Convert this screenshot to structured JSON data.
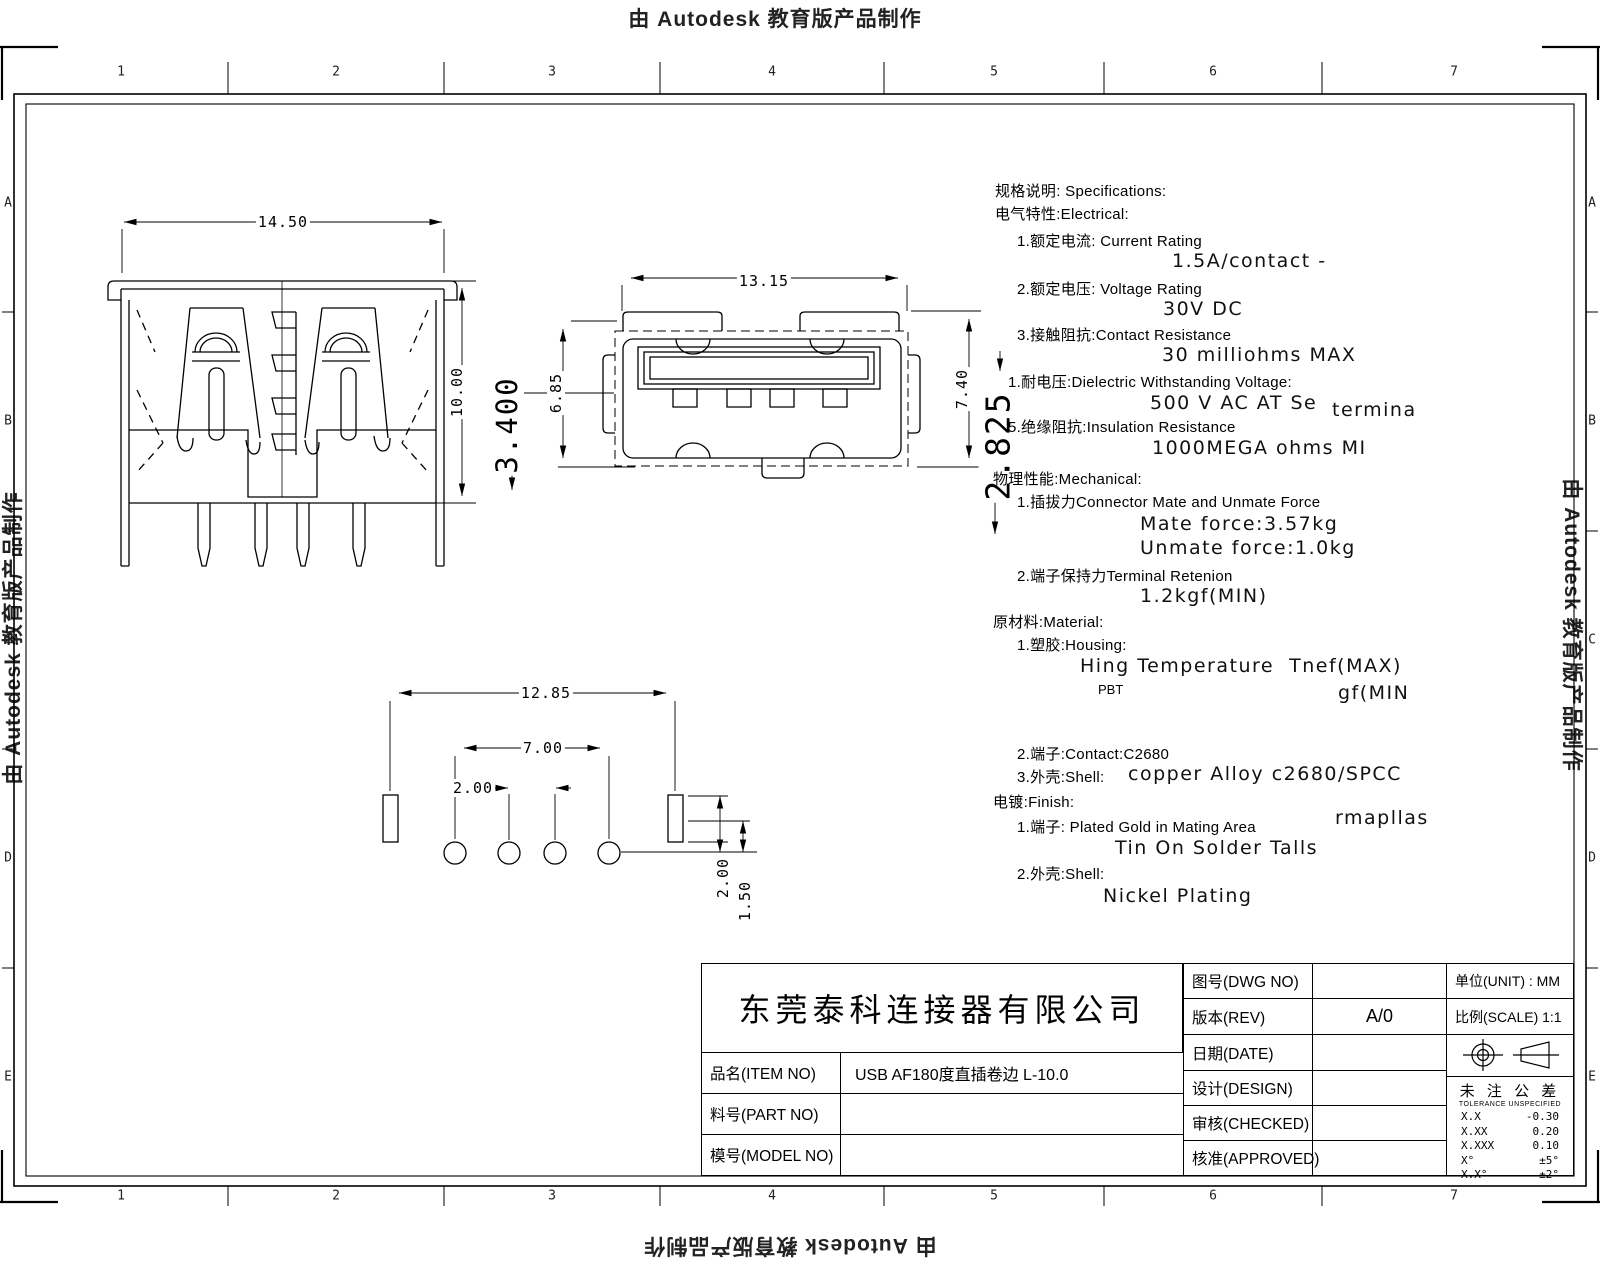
{
  "banner": {
    "text": "由 Autodesk 教育版产品制作"
  },
  "zones": {
    "cols": [
      "1",
      "2",
      "3",
      "4",
      "5",
      "6",
      "7"
    ],
    "rows": [
      "A",
      "B",
      "C",
      "D",
      "E"
    ]
  },
  "dims": {
    "front_width": "14.50",
    "front_height": "10.00",
    "front_aux": "3.400",
    "face_width": "13.15",
    "face_height_left": "6.85",
    "face_height_right": "7.40",
    "face_aux": "2.825",
    "pin_overall": "12.85",
    "pin_span": "7.00",
    "pin_pitch": "2.00",
    "pin_slot": "2.00",
    "pin_offset": "1.50"
  },
  "specs": {
    "lines": [
      {
        "t": "规格说明: Specifications:"
      },
      {
        "t": "电气特性:Electrical:"
      },
      {
        "t": "1.额定电流: Current Rating"
      },
      {
        "t": "1.5A/contact -"
      },
      {
        "t": "2.额定电压: Voltage Rating"
      },
      {
        "t": "30V DC"
      },
      {
        "t": "3.接触阻抗:Contact Resistance"
      },
      {
        "t": "30 milliohms MAX"
      },
      {
        "t": "1.耐电压:Dielectric Withstanding Voltage:"
      },
      {
        "t": "500 V AC AT Se"
      },
      {
        "t": "termina"
      },
      {
        "t": "5.绝缘阻抗:Insulation Resistance"
      },
      {
        "t": "1000MEGA ohms MI"
      },
      {
        "t": "物理性能:Mechanical:"
      },
      {
        "t": "1.插拔力Connector Mate and Unmate Force"
      },
      {
        "t": "Mate force:3.57kg"
      },
      {
        "t": "Unmate force:1.0kg"
      },
      {
        "t": "2.端子保持力Terminal Retenion"
      },
      {
        "t": "1.2kgf(MIN)"
      },
      {
        "t": "原材料:Material:"
      },
      {
        "t": "1.塑胶:Housing:"
      },
      {
        "t": "Hing Temperature  Tnef(MAX)"
      },
      {
        "t": "PBT"
      },
      {
        "t": "gf(MIN"
      },
      {
        "t": "2.端子:Contact:C2680"
      },
      {
        "t": "3.外壳:Shell:"
      },
      {
        "t": "copper Alloy c2680/SPCC"
      },
      {
        "t": "电镀:Finish:"
      },
      {
        "t": "1.端子: Plated Gold in Mating Area"
      },
      {
        "t": "rmapllas"
      },
      {
        "t": "Tin On Solder Talls"
      },
      {
        "t": "2.外壳:Shell:"
      },
      {
        "t": "Nickel Plating"
      }
    ]
  },
  "title_block": {
    "company": "东莞泰科连接器有限公司",
    "item_label": "品名(ITEM NO)",
    "item_value": "USB AF180度直插卷边 L-10.0",
    "part_label": "料号(PART NO)",
    "model_label": "模号(MODEL NO)",
    "dwg_label": "图号(DWG NO)",
    "rev_label": "版本(REV)",
    "rev_value": "A/0",
    "date_label": "日期(DATE)",
    "design_label": "设计(DESIGN)",
    "checked_label": "审核(CHECKED)",
    "approved_label": "核准(APPROVED)",
    "unit_label": "单位(UNIT) : MM",
    "scale_label": "比例(SCALE) 1:1",
    "tol_title": "未 注 公 差",
    "tol_subtitle": "TOLERANCE UNSPECIFIED",
    "tol_rows": [
      [
        "X.X",
        "-0.30"
      ],
      [
        "X.XX",
        "0.20"
      ],
      [
        "X.XXX",
        "0.10"
      ],
      [
        "X°",
        "±5°"
      ],
      [
        "X.X°",
        "±2°"
      ]
    ]
  }
}
